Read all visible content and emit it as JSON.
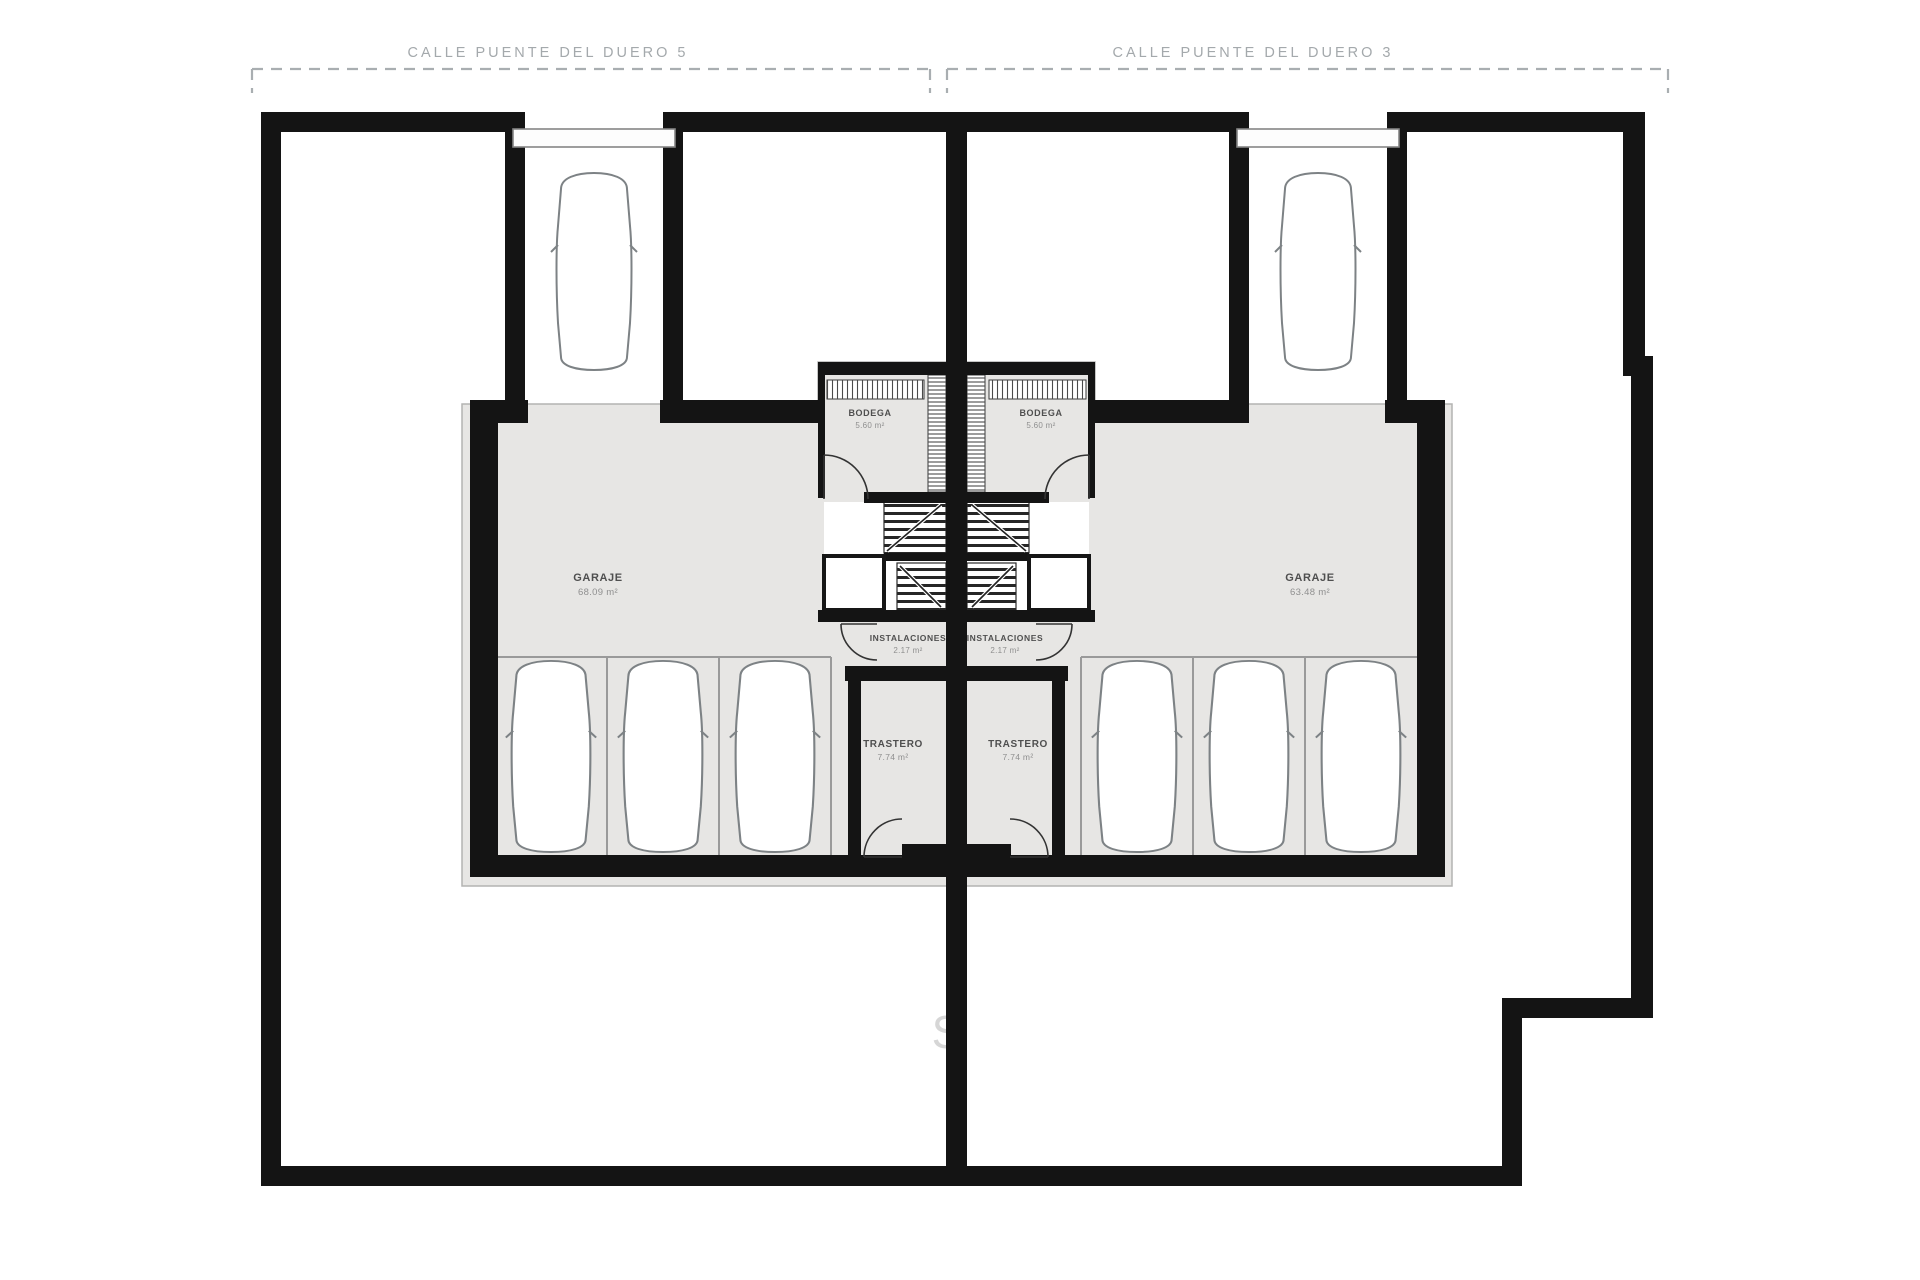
{
  "streets": {
    "left": {
      "label": "CALLE PUENTE DEL DUERO 5"
    },
    "right": {
      "label": "CALLE PUENTE DEL DUERO 3"
    }
  },
  "rooms": {
    "garaje_left": {
      "label": "GARAJE",
      "area": "68.09 m²"
    },
    "garaje_right": {
      "label": "GARAJE",
      "area": "63.48 m²"
    },
    "bodega_left": {
      "label": "BODEGA",
      "area": "5.60 m²"
    },
    "bodega_right": {
      "label": "BODEGA",
      "area": "5.60 m²"
    },
    "instalaciones_left": {
      "label": "INSTALACIONES",
      "area": "2.17 m²"
    },
    "instalaciones_right": {
      "label": "INSTALACIONES",
      "area": "2.17 m²"
    },
    "trastero_left": {
      "label": "TRASTERO",
      "area": "7.74 m²"
    },
    "trastero_right": {
      "label": "TRASTERO",
      "area": "7.74 m²"
    }
  },
  "watermark": {
    "text": "S"
  },
  "colors": {
    "wall": "#141414",
    "floor": "#e7e6e4",
    "thin_line": "#9a9a9a",
    "street_annotation": "#a4a9ac",
    "label": "#4f4f4f"
  }
}
